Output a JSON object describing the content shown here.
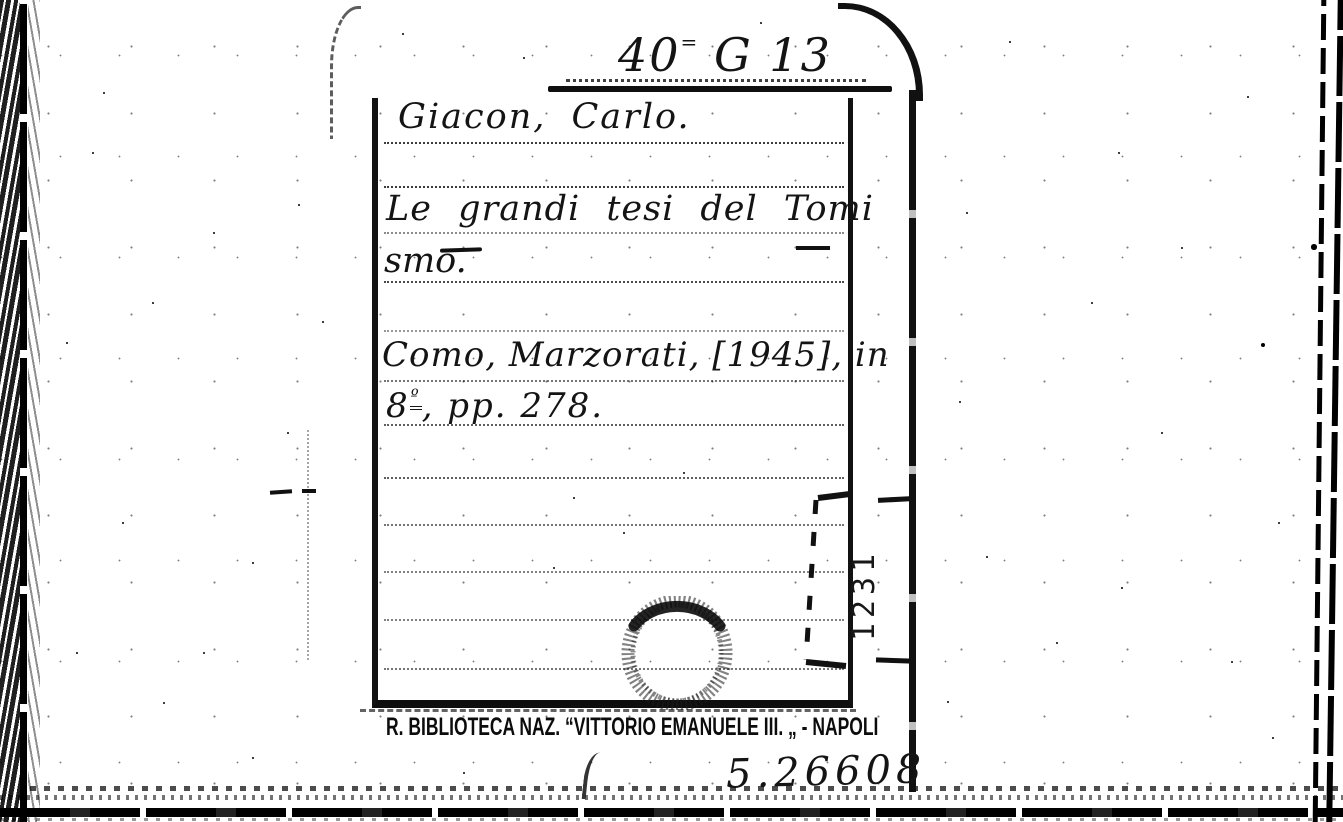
{
  "card": {
    "shelfmark_number": "40",
    "shelfmark_sup": "=",
    "shelfmark_class": "G 13",
    "author": "Giacon, Carlo.",
    "title_line1": "Le grandi tesi del Tomi",
    "title_line2": "smo.",
    "imprint_line1": "Como, Marzorati, [1945], in",
    "format_digit": "8",
    "format_sup": "º",
    "imprint_line2_rest": ", pp. 278.",
    "side_number": "1231",
    "stamp_text": "R. BIBLIOTECA NAZ. “VITTORIO EMANUELE III. „ - NAPOLI",
    "accession_number": "5.26608"
  },
  "colors": {
    "ink": "#131313",
    "paper": "#ffffff"
  }
}
